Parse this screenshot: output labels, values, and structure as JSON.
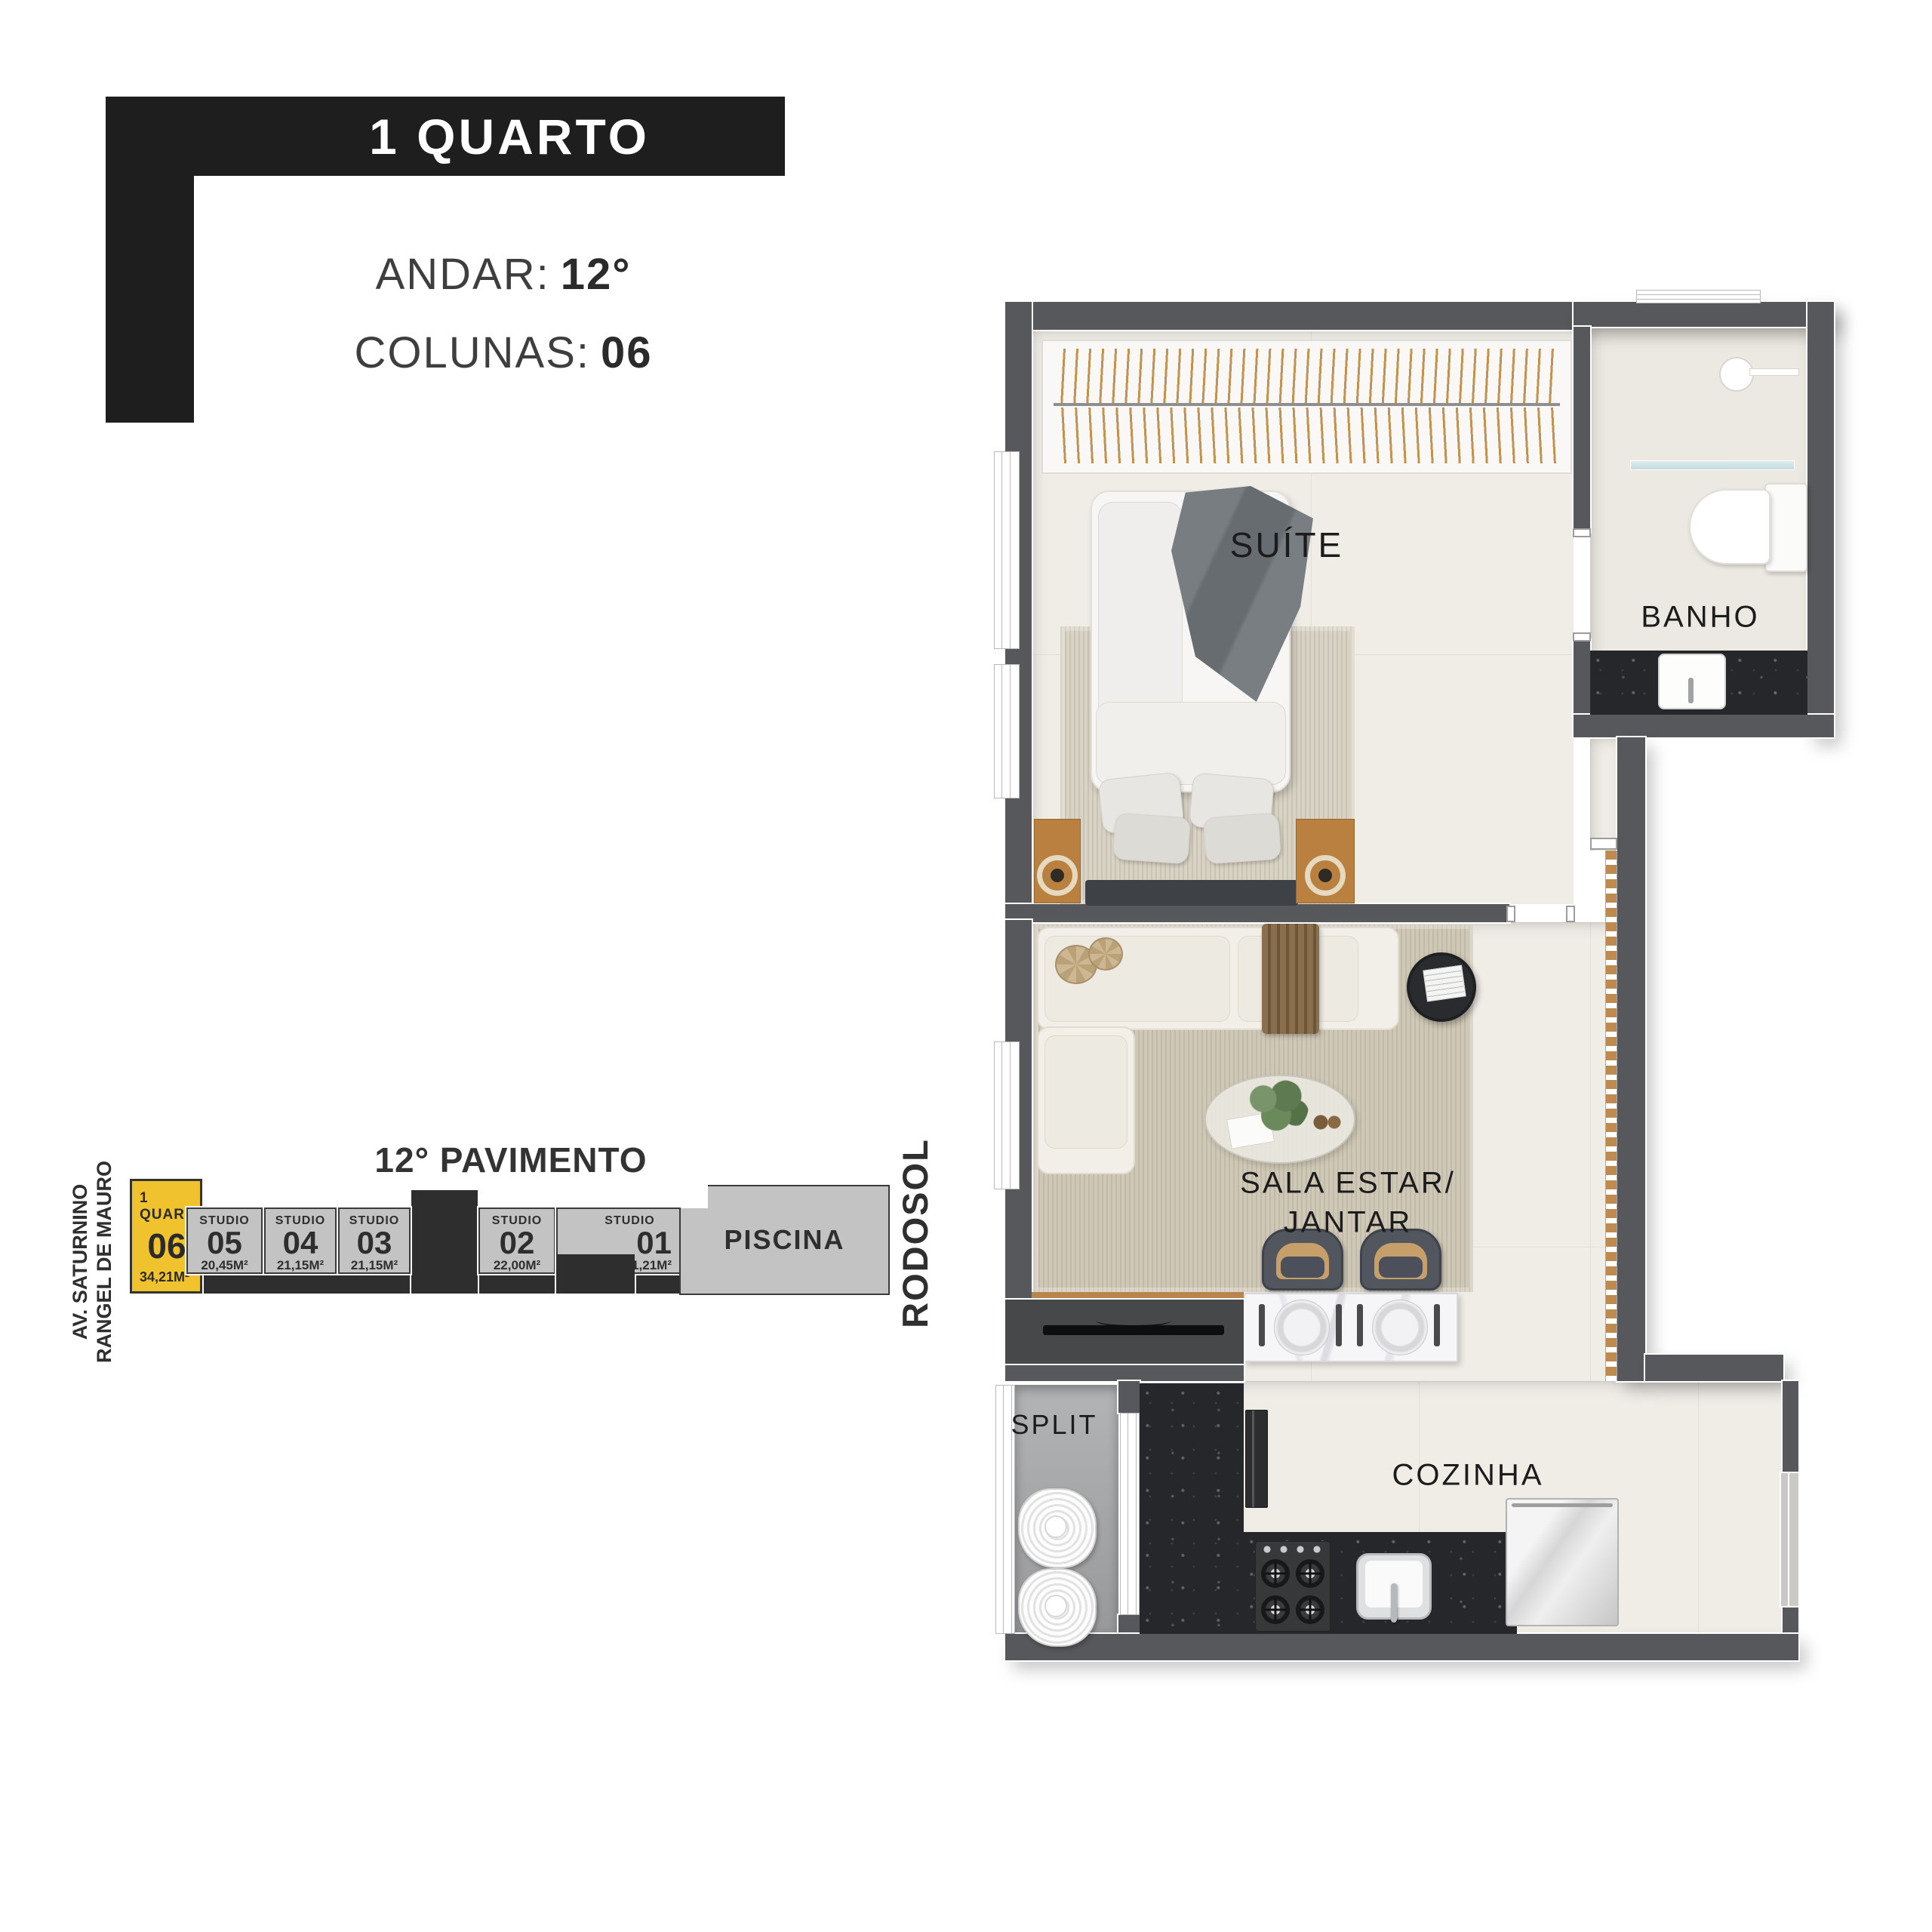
{
  "header": {
    "category": "1 QUARTO",
    "floor_label": "ANDAR:",
    "floor_value": "12°",
    "columns_label": "COLUNAS:",
    "columns_value": "06"
  },
  "section_diagram": {
    "title": "12° PAVIMENTO",
    "street_left_line1": "AV. SATURNINO",
    "street_left_line2": "RANGEL DE MAURO",
    "street_right": "RODOSOL",
    "pool_label": "PISCINA",
    "units": [
      {
        "id": "06",
        "type": "1 QUARTO",
        "area": "34,21M²",
        "highlight": true
      },
      {
        "id": "05",
        "type": "STUDIO",
        "area": "20,45M²",
        "highlight": false
      },
      {
        "id": "04",
        "type": "STUDIO",
        "area": "21,15M²",
        "highlight": false
      },
      {
        "id": "03",
        "type": "STUDIO",
        "area": "21,15M²",
        "highlight": false
      },
      {
        "id": "02",
        "type": "STUDIO",
        "area": "22,00M²",
        "highlight": false
      },
      {
        "id": "01",
        "type": "STUDIO",
        "area": "21,21M²",
        "highlight": false
      }
    ]
  },
  "floor_plan": {
    "rooms": {
      "suite": "SUÍTE",
      "banho": "BANHO",
      "sala_line1": "SALA ESTAR/",
      "sala_line2": "JANTAR",
      "split": "SPLIT",
      "cozinha": "COZINHA"
    }
  },
  "colors": {
    "accent_yellow": "#f0c22e",
    "header_black": "#1e1e1e",
    "wall_gray": "#57585b",
    "unit_gray": "#c3c3c4",
    "block_dark": "#2e2e2f"
  }
}
